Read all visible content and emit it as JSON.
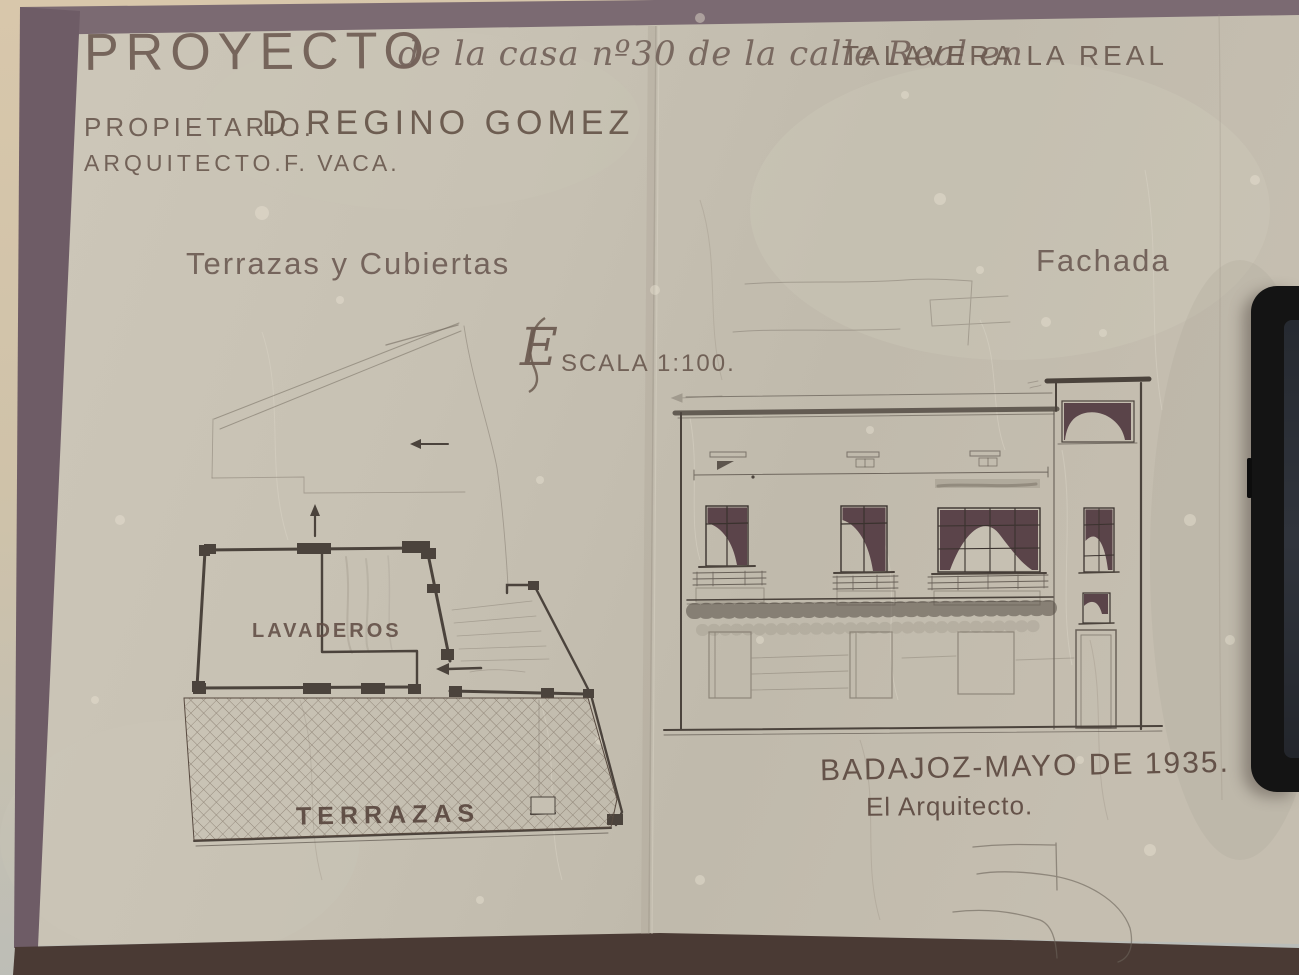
{
  "photo": {
    "title": {
      "project_word": "PROYECTO",
      "script_mid": "de la casa nº30 de la calle Real en",
      "location": "TALAVERA LA REAL"
    },
    "credits": {
      "owner_label": "PROPIETARIO.",
      "owner_name": "D.REGINO GOMEZ",
      "architect_label": "ARQUITECTO.",
      "architect_name": "F. VACA."
    },
    "sections": {
      "plan_label": "Terrazas y Cubiertas",
      "facade_label": "Fachada"
    },
    "scale": {
      "initial": "E",
      "rest": "SCALA 1:100."
    },
    "plan_rooms": {
      "lavaderos": "LAVADEROS",
      "terrazas": "TERRAZAS"
    },
    "footer": {
      "place_date": "BADAJOZ-MAYO DE 1935.",
      "signer": "El Arquitecto."
    },
    "colors": {
      "paper": "#c6c0b2",
      "border_band": "#7b6a72",
      "border_bottom": "#4a3a34",
      "ink": "#4b433c",
      "pencil": "#6e655a",
      "window_fill": "#523a41",
      "lettering": "#6b5a50",
      "phone_body": "#141414",
      "phone_screen": "#2c3036"
    },
    "objects": {
      "phone": "smartphone"
    }
  }
}
